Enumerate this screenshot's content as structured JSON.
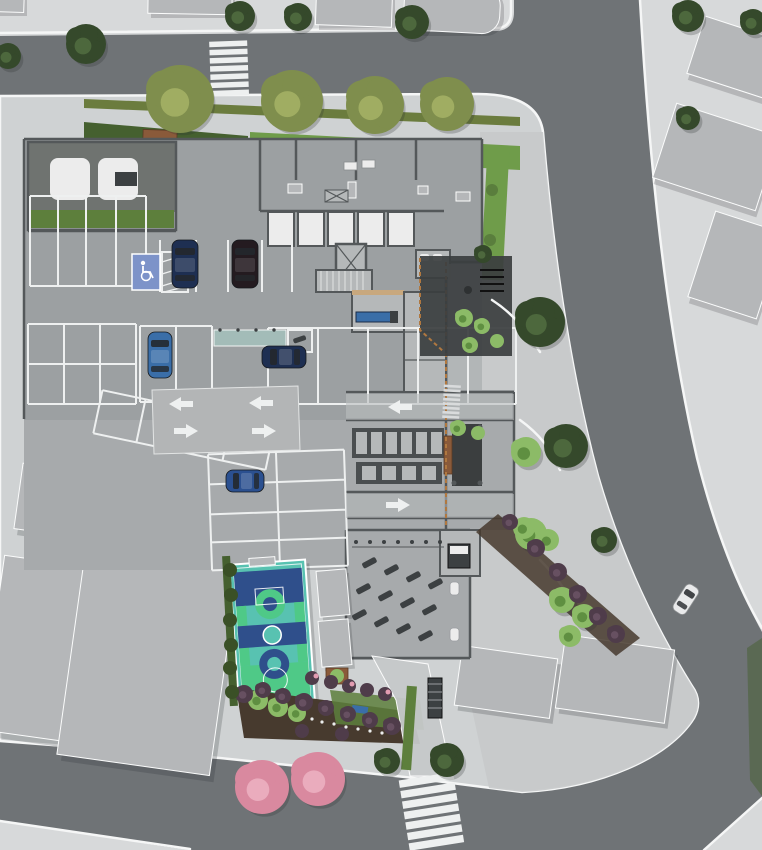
{
  "scene": {
    "type": "architectural-site-plan-render",
    "view": "top-down aerial",
    "label": "Aerial 3D render of a residential building ground-floor site plan with parking garage, amenity areas, basketball court, gardens and surrounding streets with crosswalks"
  },
  "palette": {
    "sidewalk": "#d7d9da",
    "road": "#6f7376",
    "site_plate": "#cfd2d3",
    "plaza": "#c6c9ca",
    "curb": "#f5f6f6",
    "garage": "#9ca0a2",
    "garage_lower": "#a7aaac",
    "wall": "#54585a",
    "marking": "#eef0f0",
    "slab": "#b5b7b9",
    "shadow": "#2b2f31",
    "ramp": "#b3b5b6",
    "hedge_bright": "#6f9c4a",
    "hedge_dark": "#45602f",
    "grass_strip": "#6b7c3e",
    "grass_dark": "#5d7f3c",
    "mulch": "#473a2e",
    "wood_tan": "#c8a87e",
    "bench_wood": "#8a5a3a",
    "fence_wood": "#b07840",
    "room_floor": "#b5b8b9",
    "room_white": "#ececec",
    "room_dark": "#6f7370",
    "locker": "#4a4e50",
    "equip": "#3c4042",
    "deck": "#3b3e3f",
    "canopy": "#a3bcb8",
    "court_teal": "#58c2b1",
    "court_navy": "#2f4f8b",
    "court_green": "#4fc987",
    "handicap_blue": "#7d93c9",
    "car_navy": "#1e2f52",
    "car_dark": "#241b20",
    "car_blue": "#3a6ea8",
    "car_blue2": "#2b5090",
    "car_white": "#e9eaeb",
    "car_glass": "#24282c",
    "tree_olive": "#7f8e4d",
    "tree_olive_hi": "#a0ad62",
    "tree_dark": "#35492b",
    "tree_dark_hi": "#4d683d",
    "palm": "#8cbb67",
    "palm_hi": "#5f8f41",
    "pink_tree": "#d9899f",
    "pink_tree_hi": "#eaacbd",
    "shrub_purple": "#4f3c4a",
    "shrub_purple_hi": "#675061",
    "hedge_blob": "#3a5026",
    "flower_pink": "#e39cb1",
    "flower_white": "#eceded"
  },
  "icons": {
    "accessible_parking": "wheelchair-symbol",
    "direction_arrow": "white-painted-arrow"
  },
  "inventory": {
    "roads": [
      {
        "id": "road-north",
        "label": "street along the north edge with zebra crosswalk"
      },
      {
        "id": "road-east",
        "label": "curved street along the east edge"
      },
      {
        "id": "road-south",
        "label": "street along the south edge with zebra crosswalk"
      }
    ],
    "crosswalks": [
      {
        "id": "crosswalk-north",
        "stripes": 7
      },
      {
        "id": "crosswalk-south",
        "stripes": 7
      },
      {
        "id": "walkway-stripes-east-entry",
        "stripes": 8
      }
    ],
    "cars": [
      {
        "id": "car-navy-garage-vertical",
        "color_key": "car_navy"
      },
      {
        "id": "car-black-garage-vertical",
        "color_key": "car_dark"
      },
      {
        "id": "car-blue-garage-vertical",
        "color_key": "car_blue"
      },
      {
        "id": "car-navy-garage-horizontal",
        "color_key": "car_navy"
      },
      {
        "id": "car-blue-lower-parking",
        "color_key": "car_blue2"
      },
      {
        "id": "car-white-on-street",
        "color_key": "car_white"
      }
    ],
    "amenities": [
      {
        "id": "basketball-court",
        "label": "basketball court with teal, navy and green surface"
      },
      {
        "id": "parking-garage",
        "label": "striped parking bays with one accessible spot"
      },
      {
        "id": "garage-ramp",
        "label": "garage ramp with four painted direction arrows"
      },
      {
        "id": "storage-lockers",
        "label": "rows of storage lockers"
      },
      {
        "id": "equipment-area",
        "label": "outdoor gym equipment area"
      },
      {
        "id": "wood-deck",
        "label": "dark deck terrace with bench"
      },
      {
        "id": "south-garden",
        "label": "south garden bed with shrubs and flowering trees"
      }
    ],
    "markings": {
      "direction_arrows": 6,
      "accessible_spots": 1,
      "pink_flowering_trees": 2
    }
  },
  "landscape": {
    "trees": [
      {
        "t": "olive",
        "x": 180,
        "y": 99,
        "r": 34
      },
      {
        "t": "olive",
        "x": 292,
        "y": 101,
        "r": 31
      },
      {
        "t": "olive",
        "x": 375,
        "y": 105,
        "r": 29
      },
      {
        "t": "olive",
        "x": 447,
        "y": 104,
        "r": 27
      },
      {
        "t": "dark",
        "x": 86,
        "y": 44,
        "r": 20
      },
      {
        "t": "dark",
        "x": 8,
        "y": 56,
        "r": 13
      },
      {
        "t": "dark",
        "x": 240,
        "y": 16,
        "r": 15
      },
      {
        "t": "dark",
        "x": 298,
        "y": 17,
        "r": 14
      },
      {
        "t": "dark",
        "x": 412,
        "y": 22,
        "r": 17
      },
      {
        "t": "dark",
        "x": 688,
        "y": 16,
        "r": 16
      },
      {
        "t": "dark",
        "x": 753,
        "y": 22,
        "r": 13
      },
      {
        "t": "dark",
        "x": 688,
        "y": 118,
        "r": 12
      },
      {
        "t": "dark",
        "x": 540,
        "y": 322,
        "r": 25
      },
      {
        "t": "dark",
        "x": 566,
        "y": 446,
        "r": 22
      },
      {
        "t": "dark",
        "x": 604,
        "y": 540,
        "r": 13
      },
      {
        "t": "dark",
        "x": 483,
        "y": 254,
        "r": 9
      },
      {
        "t": "dark",
        "x": 387,
        "y": 761,
        "r": 13
      },
      {
        "t": "dark",
        "x": 447,
        "y": 760,
        "r": 17
      },
      {
        "t": "palm",
        "x": 526,
        "y": 452,
        "r": 15
      },
      {
        "t": "palm",
        "x": 531,
        "y": 534,
        "r": 16
      },
      {
        "t": "palm",
        "x": 258,
        "y": 700,
        "r": 10
      },
      {
        "t": "palm",
        "x": 278,
        "y": 707,
        "r": 10
      },
      {
        "t": "palm",
        "x": 297,
        "y": 713,
        "r": 9
      },
      {
        "t": "palm",
        "x": 524,
        "y": 528,
        "r": 11
      },
      {
        "t": "palm",
        "x": 548,
        "y": 540,
        "r": 11
      },
      {
        "t": "palm",
        "x": 562,
        "y": 600,
        "r": 13
      },
      {
        "t": "palm",
        "x": 584,
        "y": 616,
        "r": 12
      },
      {
        "t": "palm",
        "x": 570,
        "y": 636,
        "r": 11
      },
      {
        "t": "palm",
        "x": 464,
        "y": 318,
        "r": 9
      },
      {
        "t": "palm",
        "x": 482,
        "y": 326,
        "r": 8
      },
      {
        "t": "palm",
        "x": 470,
        "y": 345,
        "r": 8
      },
      {
        "t": "palm",
        "x": 497,
        "y": 341,
        "r": 7
      },
      {
        "t": "palm",
        "x": 458,
        "y": 428,
        "r": 8
      },
      {
        "t": "palm",
        "x": 478,
        "y": 433,
        "r": 7
      },
      {
        "t": "palm",
        "x": 337,
        "y": 676,
        "r": 7
      },
      {
        "t": "pink",
        "x": 262,
        "y": 787,
        "r": 27
      },
      {
        "t": "pink",
        "x": 318,
        "y": 779,
        "r": 27
      },
      {
        "t": "shrub",
        "x": 244,
        "y": 694,
        "r": 9
      },
      {
        "t": "shrub",
        "x": 263,
        "y": 690,
        "r": 8
      },
      {
        "t": "shrub",
        "x": 283,
        "y": 696,
        "r": 8
      },
      {
        "t": "shrub",
        "x": 304,
        "y": 702,
        "r": 9
      },
      {
        "t": "shrub",
        "x": 326,
        "y": 708,
        "r": 8
      },
      {
        "t": "shrub",
        "x": 348,
        "y": 714,
        "r": 8
      },
      {
        "t": "shrub",
        "x": 370,
        "y": 720,
        "r": 8
      },
      {
        "t": "shrub",
        "x": 392,
        "y": 726,
        "r": 9
      },
      {
        "t": "shrub",
        "x": 302,
        "y": 731,
        "r": 7
      },
      {
        "t": "shrub",
        "x": 342,
        "y": 734,
        "r": 7
      },
      {
        "t": "shrub",
        "x": 312,
        "y": 678,
        "r": 7
      },
      {
        "t": "shrub",
        "x": 331,
        "y": 682,
        "r": 7
      },
      {
        "t": "shrub",
        "x": 349,
        "y": 686,
        "r": 7
      },
      {
        "t": "shrub",
        "x": 367,
        "y": 690,
        "r": 7
      },
      {
        "t": "shrub",
        "x": 385,
        "y": 694,
        "r": 7
      },
      {
        "t": "shrub",
        "x": 510,
        "y": 522,
        "r": 8
      },
      {
        "t": "shrub",
        "x": 536,
        "y": 548,
        "r": 9
      },
      {
        "t": "shrub",
        "x": 558,
        "y": 572,
        "r": 9
      },
      {
        "t": "shrub",
        "x": 578,
        "y": 594,
        "r": 9
      },
      {
        "t": "shrub",
        "x": 598,
        "y": 616,
        "r": 9
      },
      {
        "t": "shrub",
        "x": 616,
        "y": 634,
        "r": 9
      },
      {
        "t": "blob",
        "x": 230,
        "y": 570,
        "r": 7
      },
      {
        "t": "blob",
        "x": 231,
        "y": 595,
        "r": 7
      },
      {
        "t": "blob",
        "x": 230,
        "y": 620,
        "r": 7
      },
      {
        "t": "blob",
        "x": 231,
        "y": 645,
        "r": 7
      },
      {
        "t": "blob",
        "x": 230,
        "y": 668,
        "r": 7
      },
      {
        "t": "blob",
        "x": 232,
        "y": 692,
        "r": 7
      },
      {
        "t": "pinkdot",
        "x": 316,
        "y": 676,
        "r": 2.5
      },
      {
        "t": "pinkdot",
        "x": 352,
        "y": 684,
        "r": 2.5
      },
      {
        "t": "pinkdot",
        "x": 388,
        "y": 692,
        "r": 2.5
      },
      {
        "t": "white",
        "x": 312,
        "y": 719,
        "r": 1.6
      },
      {
        "t": "white",
        "x": 322,
        "y": 722,
        "r": 1.6
      },
      {
        "t": "white",
        "x": 334,
        "y": 724,
        "r": 1.6
      },
      {
        "t": "white",
        "x": 346,
        "y": 727,
        "r": 1.6
      },
      {
        "t": "white",
        "x": 358,
        "y": 729,
        "r": 1.6
      },
      {
        "t": "white",
        "x": 370,
        "y": 731,
        "r": 1.6
      },
      {
        "t": "white",
        "x": 382,
        "y": 733,
        "r": 1.6
      }
    ]
  }
}
